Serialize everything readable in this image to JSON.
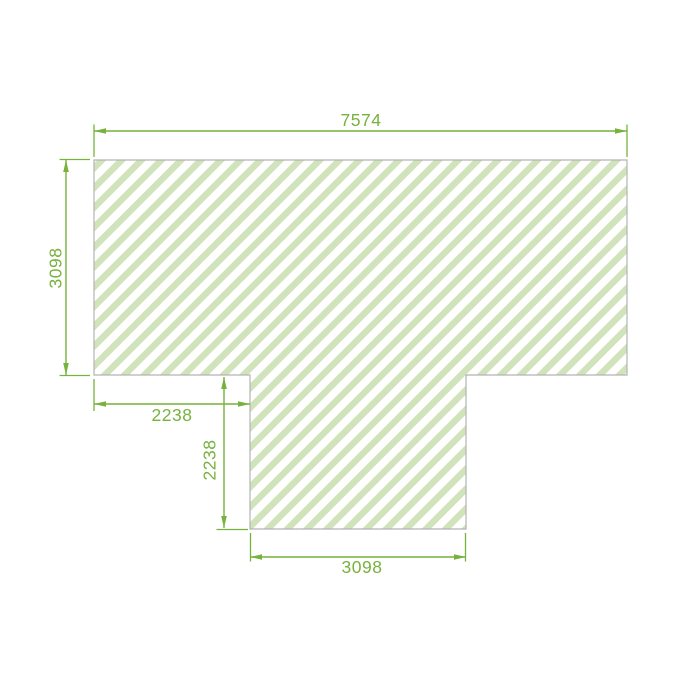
{
  "drawing": {
    "title": "t-shaped-panel-dimension-drawing",
    "shape": {
      "name": "t-shaped-hatched-panel",
      "fill_pattern": "diagonal-stripes-45deg"
    },
    "dimensions": [
      {
        "id": "top-width",
        "value": "7574",
        "orientation": "horizontal",
        "position": "top"
      },
      {
        "id": "left-height",
        "value": "3098",
        "orientation": "vertical",
        "position": "left"
      },
      {
        "id": "notch-width",
        "value": "2238",
        "orientation": "horizontal",
        "position": "below-left-notch"
      },
      {
        "id": "stem-height",
        "value": "2238",
        "orientation": "vertical",
        "position": "left-of-stem"
      },
      {
        "id": "stem-width",
        "value": "3098",
        "orientation": "horizontal",
        "position": "bottom"
      }
    ]
  },
  "colors": {
    "dimension_green": "#76b23c",
    "hatch_stripe": "#d0e3ba",
    "shape_outline": "#b3b3b3",
    "shape_fill": "#ffffff",
    "canvas_bg": "#ffffff"
  }
}
